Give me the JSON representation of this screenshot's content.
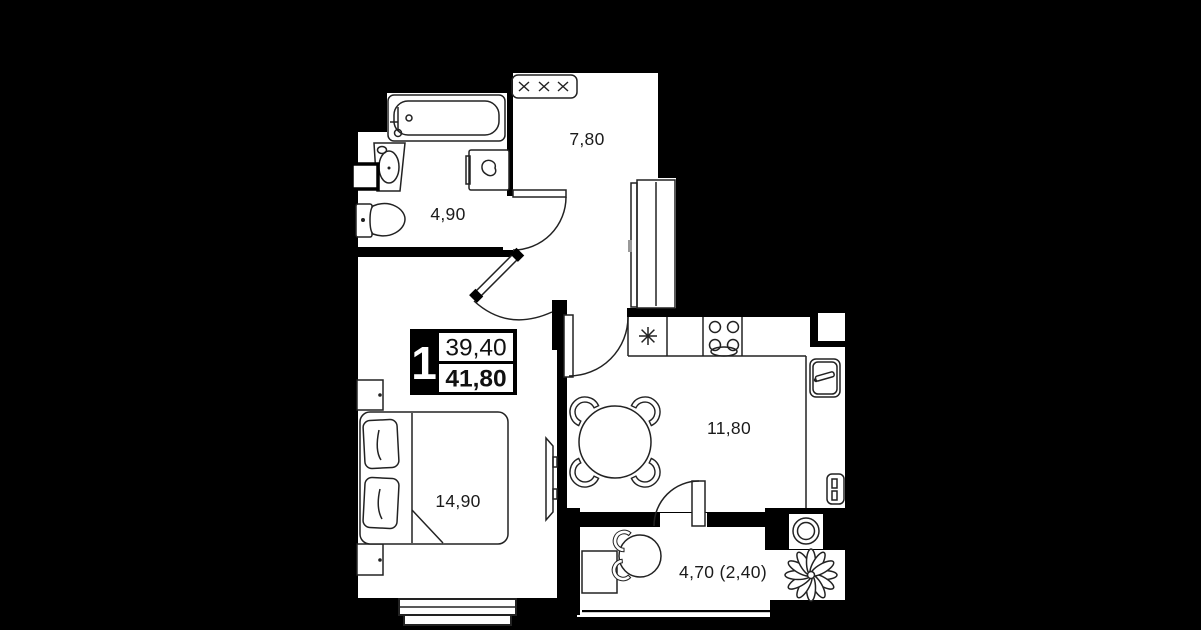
{
  "badge": {
    "rooms_count": "1",
    "living_area": "39,40",
    "total_area": "41,80"
  },
  "rooms": {
    "hallway": {
      "area_label": "7,80"
    },
    "bathroom": {
      "area_label": "4,90"
    },
    "kitchen": {
      "area_label": "11,80"
    },
    "bedroom": {
      "area_label": "14,90"
    },
    "balcony": {
      "area_label": "4,70 (2,40)"
    }
  },
  "colors": {
    "background": "#000000",
    "floor": "#ffffff",
    "line": "#222222"
  }
}
